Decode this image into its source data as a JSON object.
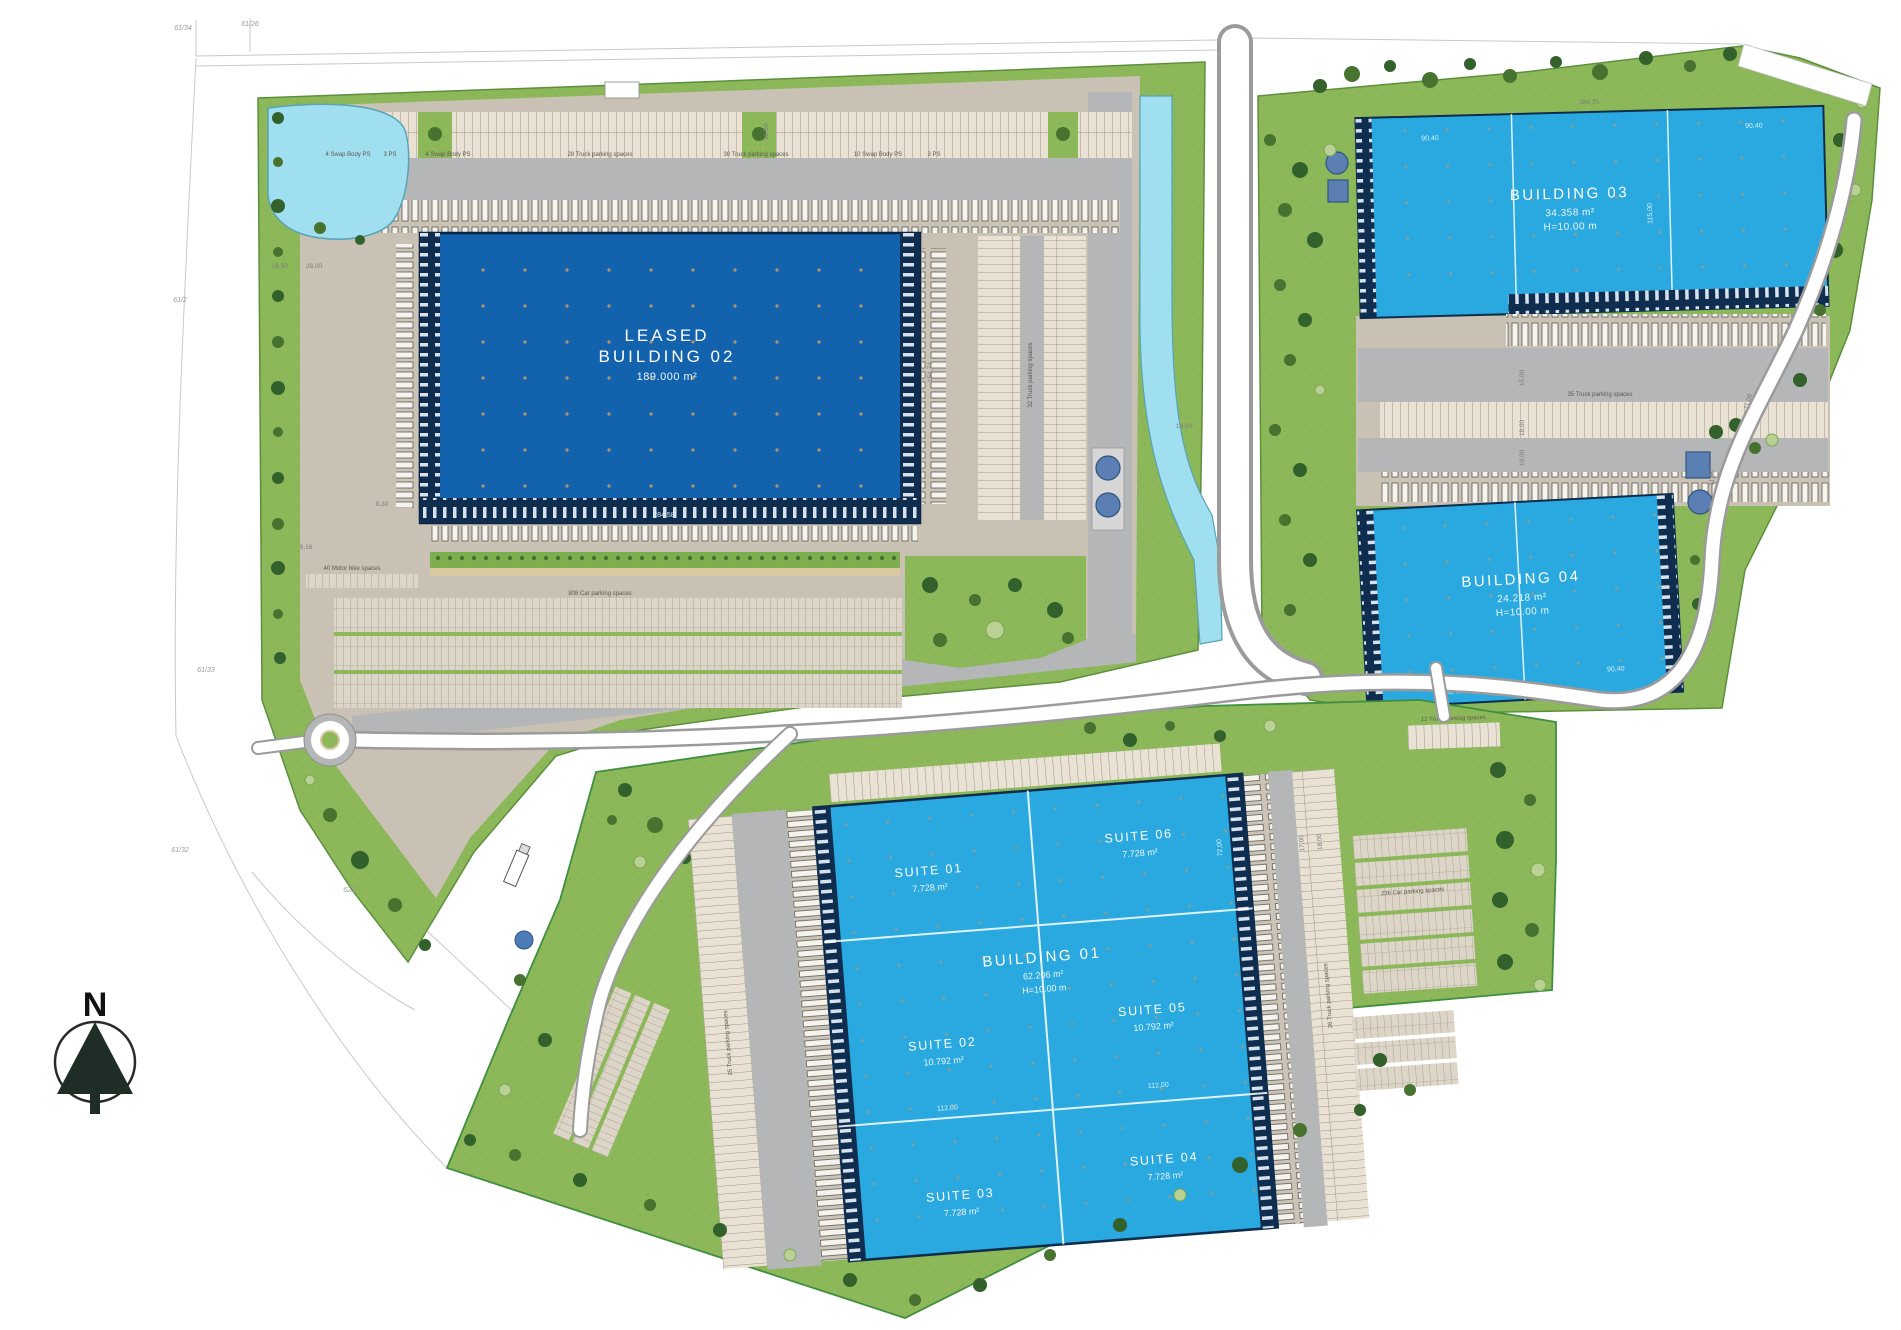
{
  "colors": {
    "grass": "#8cb85a",
    "leased_building": "#1262ae",
    "available_building": "#29a9e0",
    "dock_band": "#0f2e4f",
    "water": "#9fdfef",
    "road_gray": "#b5b6b7",
    "parking_tan": "#d9d2c5",
    "label_white": "#ffffff"
  },
  "north": {
    "label": "N"
  },
  "buildings": {
    "b01": {
      "name": "BUILDING 01",
      "area": "62.206 m²",
      "height": "H=10.00 m"
    },
    "b02": {
      "status": "LEASED",
      "name": "BUILDING 02",
      "area": "189.000 m²"
    },
    "b03": {
      "name": "BUILDING 03",
      "area": "34.358 m²",
      "height": "H=10.00 m"
    },
    "b04": {
      "name": "BUILDING 04",
      "area": "24.218 m²",
      "height": "H=10.00 m"
    },
    "suites": [
      {
        "name": "SUITE 01",
        "area": "7.728 m²"
      },
      {
        "name": "SUITE 02",
        "area": "10.792 m²"
      },
      {
        "name": "SUITE 03",
        "area": "7.728 m²"
      },
      {
        "name": "SUITE 04",
        "area": "7.728 m²"
      },
      {
        "name": "SUITE 05",
        "area": "10.792 m²"
      },
      {
        "name": "SUITE 06",
        "area": "7.728 m²"
      }
    ]
  },
  "parking": {
    "swap_a": "4 Swap Body PS",
    "ps3_a": "3 PS",
    "swap_b": "4 Swap Body PS",
    "truck28": "28 Truck parking spaces",
    "truck30": "30 Truck parking spaces",
    "swap10": "10 Swap Body PS",
    "ps3_b": "3 PS",
    "car808": "808 Car parking spaces",
    "bike40": "40 Motor bike spaces",
    "truck32": "32 Truck parking spaces",
    "truck35": "35 Truck parking spaces",
    "truck26": "26 Truck parking spaces",
    "truck25": "25 Truck parking spaces",
    "truck12": "12 Truck parking spaces",
    "car236": "236 Car parking spaces"
  },
  "dims": {
    "d28458": "284,58",
    "d15174": "151,74",
    "d28435": "284,35",
    "d9040": "90,40",
    "d11500": "115,00",
    "d11200": "112,00",
    "d7200": "72,00",
    "d1850": "18,50",
    "d1650": "16,50",
    "d2800": "28,00",
    "d930": "9,30",
    "d916": "9,16",
    "d1400": "14,00",
    "d1500": "15,00",
    "d1800": "18,00",
    "d1900": "19,00",
    "d1100": "11,00",
    "d1700": "17,00"
  },
  "cadastral": [
    "61/34",
    "61/26",
    "61/2",
    "61/33",
    "61/32",
    "62/2"
  ]
}
